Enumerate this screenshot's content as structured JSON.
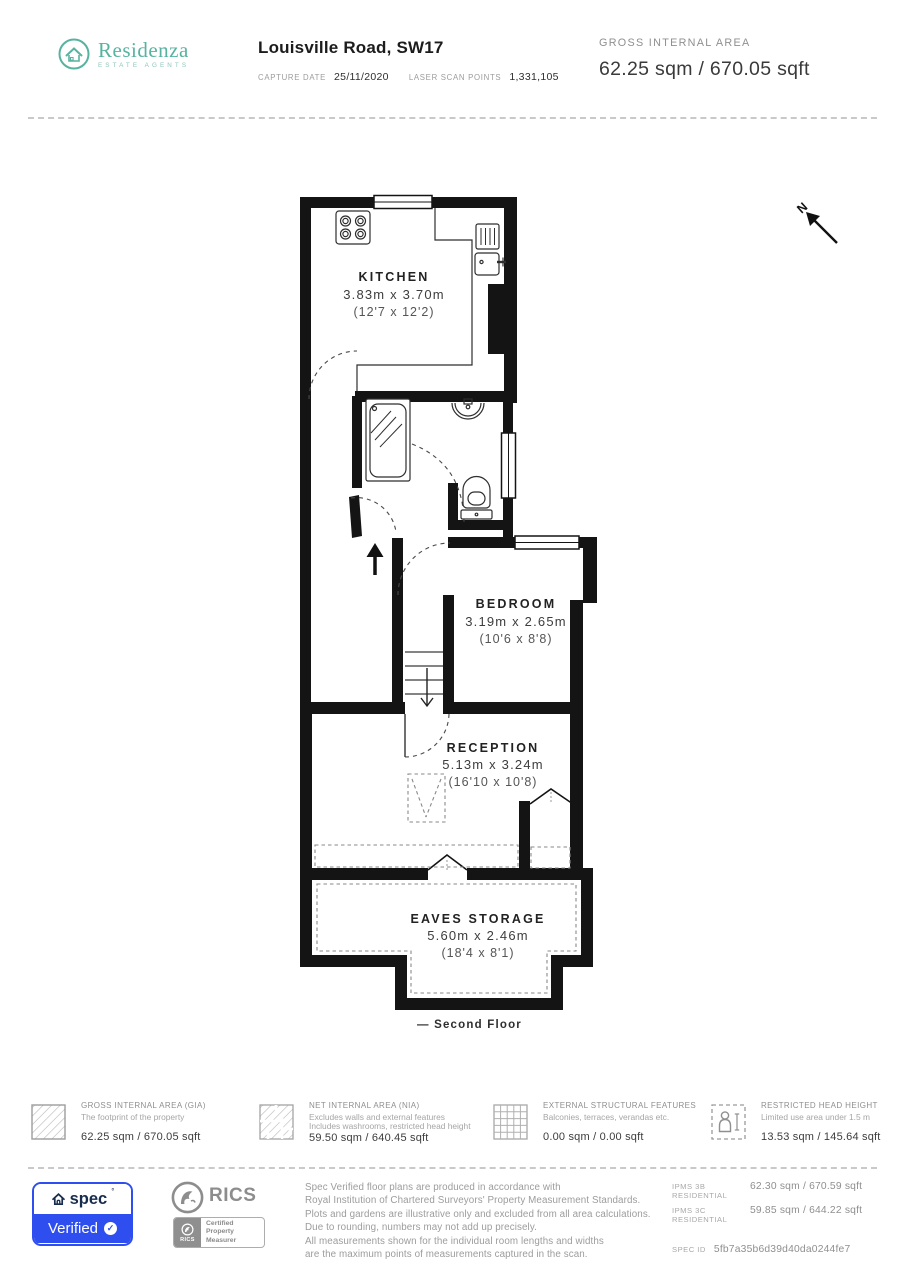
{
  "header": {
    "brand": {
      "name": "Residenza",
      "tagline": "ESTATE AGENTS"
    },
    "title": "Louisville Road, SW17",
    "capture_date_label": "CAPTURE DATE",
    "capture_date": "25/11/2020",
    "laser_label": "LASER SCAN POINTS",
    "laser_points": "1,331,105",
    "gia_label": "GROSS INTERNAL AREA",
    "gia_value": "62.25 sqm / 670.05 sqft"
  },
  "floorplan": {
    "floor_label": "— Second Floor",
    "north_label": "N",
    "rooms": [
      {
        "name": "KITCHEN",
        "dims_m": "3.83m x 3.70m",
        "dims_ft": "(12'7 x 12'2)"
      },
      {
        "name": "BEDROOM",
        "dims_m": "3.19m x 2.65m",
        "dims_ft": "(10'6 x 8'8)"
      },
      {
        "name": "RECEPTION",
        "dims_m": "5.13m x 3.24m",
        "dims_ft": "(16'10 x 10'8)"
      },
      {
        "name": "EAVES STORAGE",
        "dims_m": "5.60m x 2.46m",
        "dims_ft": "(18'4 x 8'1)"
      }
    ]
  },
  "legend": [
    {
      "icon": "hatched-square-icon",
      "title": "GROSS INTERNAL AREA (GIA)",
      "desc": [
        "The footprint of the property"
      ],
      "value": "62.25 sqm / 670.05 sqft"
    },
    {
      "icon": "hatched-floorplan-icon",
      "title": "NET INTERNAL AREA (NIA)",
      "desc": [
        "Excludes walls and external features",
        "Includes washrooms, restricted head height"
      ],
      "value": "59.50 sqm / 640.45 sqft"
    },
    {
      "icon": "grid-square-icon",
      "title": "EXTERNAL STRUCTURAL FEATURES",
      "desc": [
        "Balconies, terraces, verandas etc."
      ],
      "value": "0.00 sqm / 0.00 sqft"
    },
    {
      "icon": "person-dashed-square-icon",
      "title": "RESTRICTED HEAD HEIGHT",
      "desc": [
        "Limited use area under 1.5 m"
      ],
      "value": "13.53 sqm / 145.64 sqft"
    }
  ],
  "footer": {
    "spec_badge": {
      "brand": "spec",
      "reg_mark": "°",
      "verified": "Verified",
      "check": "✓"
    },
    "rics": {
      "name": "RICS",
      "mini_name": "RICS",
      "certified_lines": [
        "Certified",
        "Property",
        "Measurer"
      ]
    },
    "disclaimer_lines": [
      "Spec Verified floor plans are produced in accordance with",
      "Royal Institution of Chartered Surveyors' Property Measurement Standards.",
      "Plots and gardens are illustrative only and excluded from all area calculations.",
      "Due to rounding, numbers may not add up precisely.",
      "All measurements shown for the individual room lengths and widths",
      "are the maximum points of measurements captured in the scan."
    ],
    "ipms": [
      {
        "label": "IPMS 3B RESIDENTIAL",
        "value": "62.30 sqm / 670.59 sqft"
      },
      {
        "label": "IPMS 3C RESIDENTIAL",
        "value": "59.85 sqm / 644.22 sqft"
      }
    ],
    "spec_id_label": "SPEC ID",
    "spec_id": "5fb7a35b6d39d40da0244fe7"
  },
  "accent_colors": {
    "brand_teal": "#57b3a0",
    "spec_blue": "#2e4ef0",
    "wall_black": "#141414",
    "gray": "#8f8f8f"
  }
}
